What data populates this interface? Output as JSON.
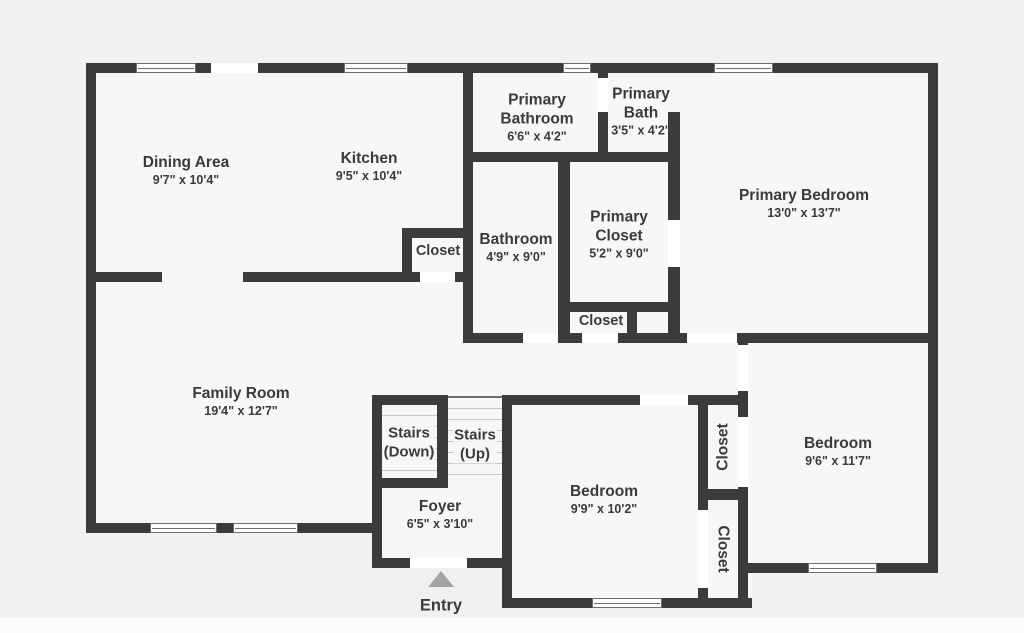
{
  "plan": {
    "type": "floor-plan",
    "colors": {
      "wall": "#3b3b3d",
      "floor": "#f7f7f6",
      "background": "#f1f1f0",
      "text": "#3a3a3c",
      "entry_arrow": "#a3a3a3"
    }
  },
  "rooms": {
    "dining": {
      "name": "Dining Area",
      "dims": "9'7\" x 10'4\""
    },
    "kitchen": {
      "name": "Kitchen",
      "dims": "9'5\" x 10'4\""
    },
    "primary_bathroom": {
      "name": "Primary Bathroom",
      "dims": "6'6\" x 4'2\""
    },
    "primary_bath": {
      "name": "Primary Bath",
      "dims": "3'5\" x 4'2\""
    },
    "primary_bedroom": {
      "name": "Primary Bedroom",
      "dims": "13'0\" x 13'7\""
    },
    "bathroom": {
      "name": "Bathroom",
      "dims": "4'9\" x 9'0\""
    },
    "primary_closet": {
      "name": "Primary Closet",
      "dims": "5'2\" x 9'0\""
    },
    "closet_kitchen": {
      "name": "Closet"
    },
    "closet_hall": {
      "name": "Closet"
    },
    "family_room": {
      "name": "Family Room",
      "dims": "19'4\" x 12'7\""
    },
    "stairs_down": {
      "line1": "Stairs",
      "line2": "(Down)"
    },
    "stairs_up": {
      "line1": "Stairs",
      "line2": "(Up)"
    },
    "foyer": {
      "name": "Foyer",
      "dims": "6'5\" x 3'10\""
    },
    "bedroom_mid": {
      "name": "Bedroom",
      "dims": "9'9\" x 10'2\""
    },
    "closet_bedroom_right": {
      "name": "Closet"
    },
    "closet_bedroom_mid": {
      "name": "Closet"
    },
    "bedroom_right": {
      "name": "Bedroom",
      "dims": "9'6\" x 11'7\""
    }
  },
  "entry": {
    "label": "Entry"
  }
}
